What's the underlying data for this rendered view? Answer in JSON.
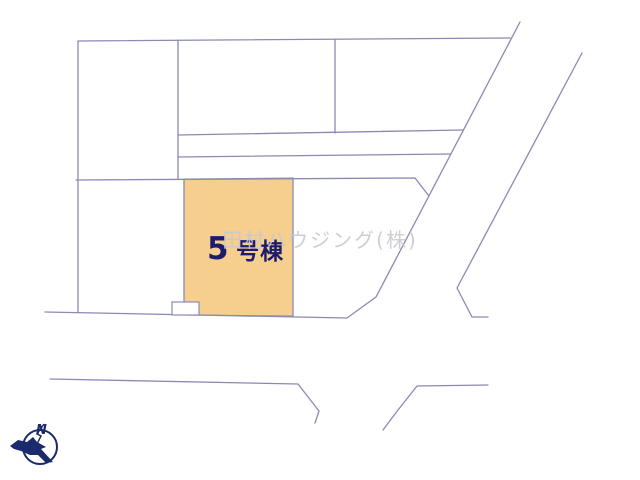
{
  "plan": {
    "lot": {
      "label_number": "5",
      "label_suffix": "号棟",
      "full_label": "5号棟"
    },
    "watermark": "田村ハウジング(株)",
    "compass": {
      "north_label": "N"
    }
  },
  "colors": {
    "background": "#FFFFFF",
    "lot_fill": "#F6CE8E",
    "lot_label": "#1C1C6E",
    "boundary_line": "#8A8AB2",
    "watermark": "#C9C9D2",
    "compass": "#1B2A6B"
  }
}
